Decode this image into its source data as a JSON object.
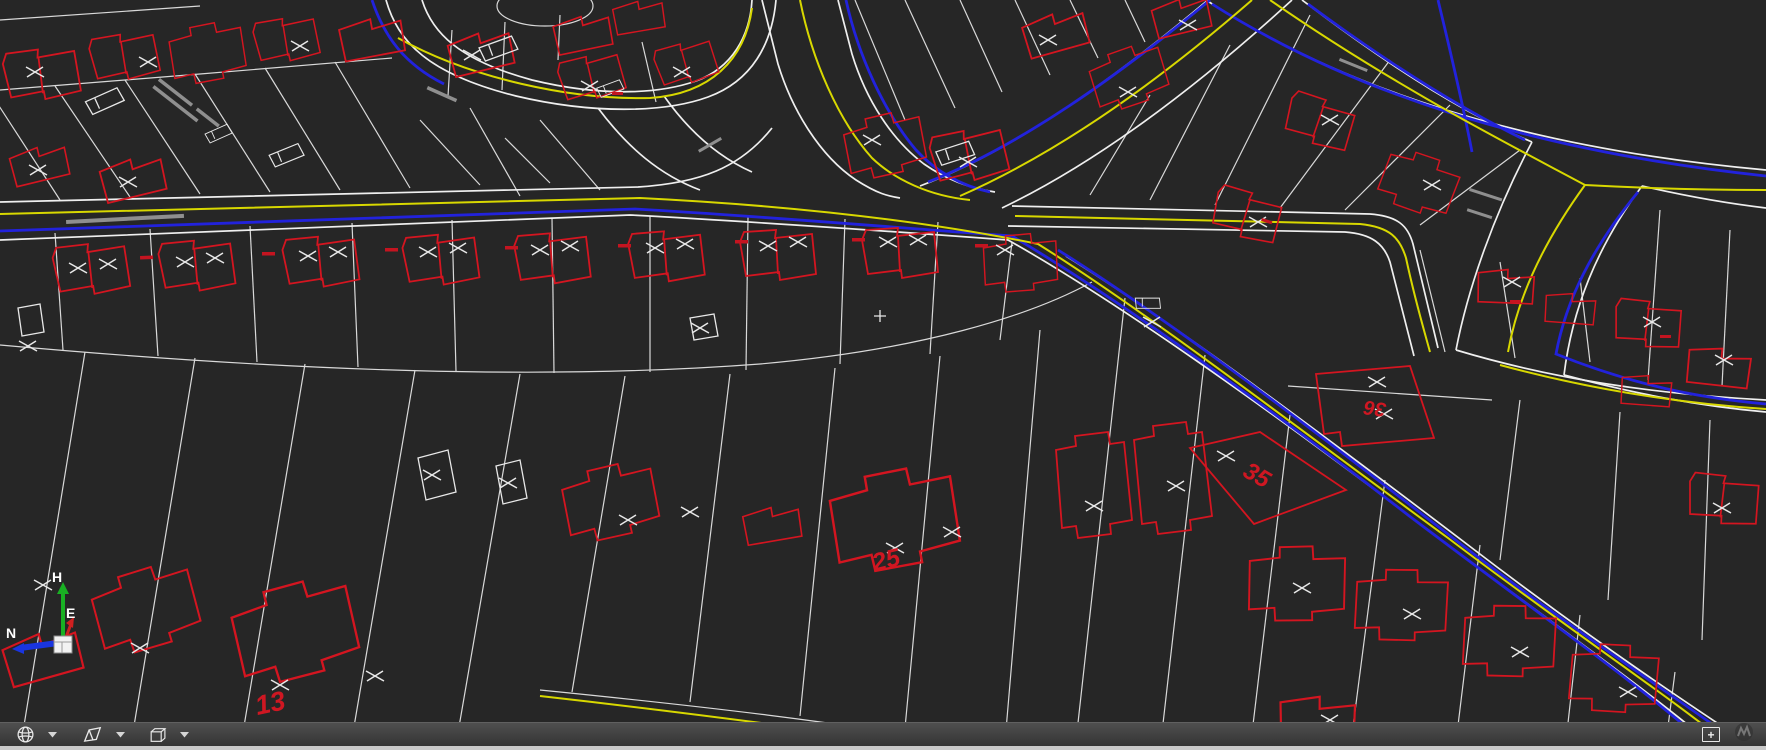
{
  "app": {
    "kind": "cad-3d-cadastral-viewport",
    "background_color": "#262626"
  },
  "layers": {
    "parcel_line_color": "#d9d9d9",
    "road_edge_color": "#efefef",
    "building_color": "#d41520",
    "utility_blue_color": "#2222dc",
    "centerline_yellow_color": "#d8d800",
    "street_label_color": "#8f8f8f"
  },
  "axis_triad": {
    "n_label": "N",
    "e_label": "E",
    "h_label": "H",
    "n_color": "#1a35e0",
    "e_color": "#d02020",
    "h_color": "#19b023"
  },
  "lot_labels": [
    {
      "value": "13"
    },
    {
      "value": "25"
    },
    {
      "value": "35"
    },
    {
      "value": "36"
    }
  ],
  "toolbar": {
    "tools": [
      {
        "name": "orbit-globe-tool"
      },
      {
        "name": "clip-volume-tool"
      },
      {
        "name": "display-style-cube-tool"
      }
    ],
    "add_view_label": "+"
  }
}
